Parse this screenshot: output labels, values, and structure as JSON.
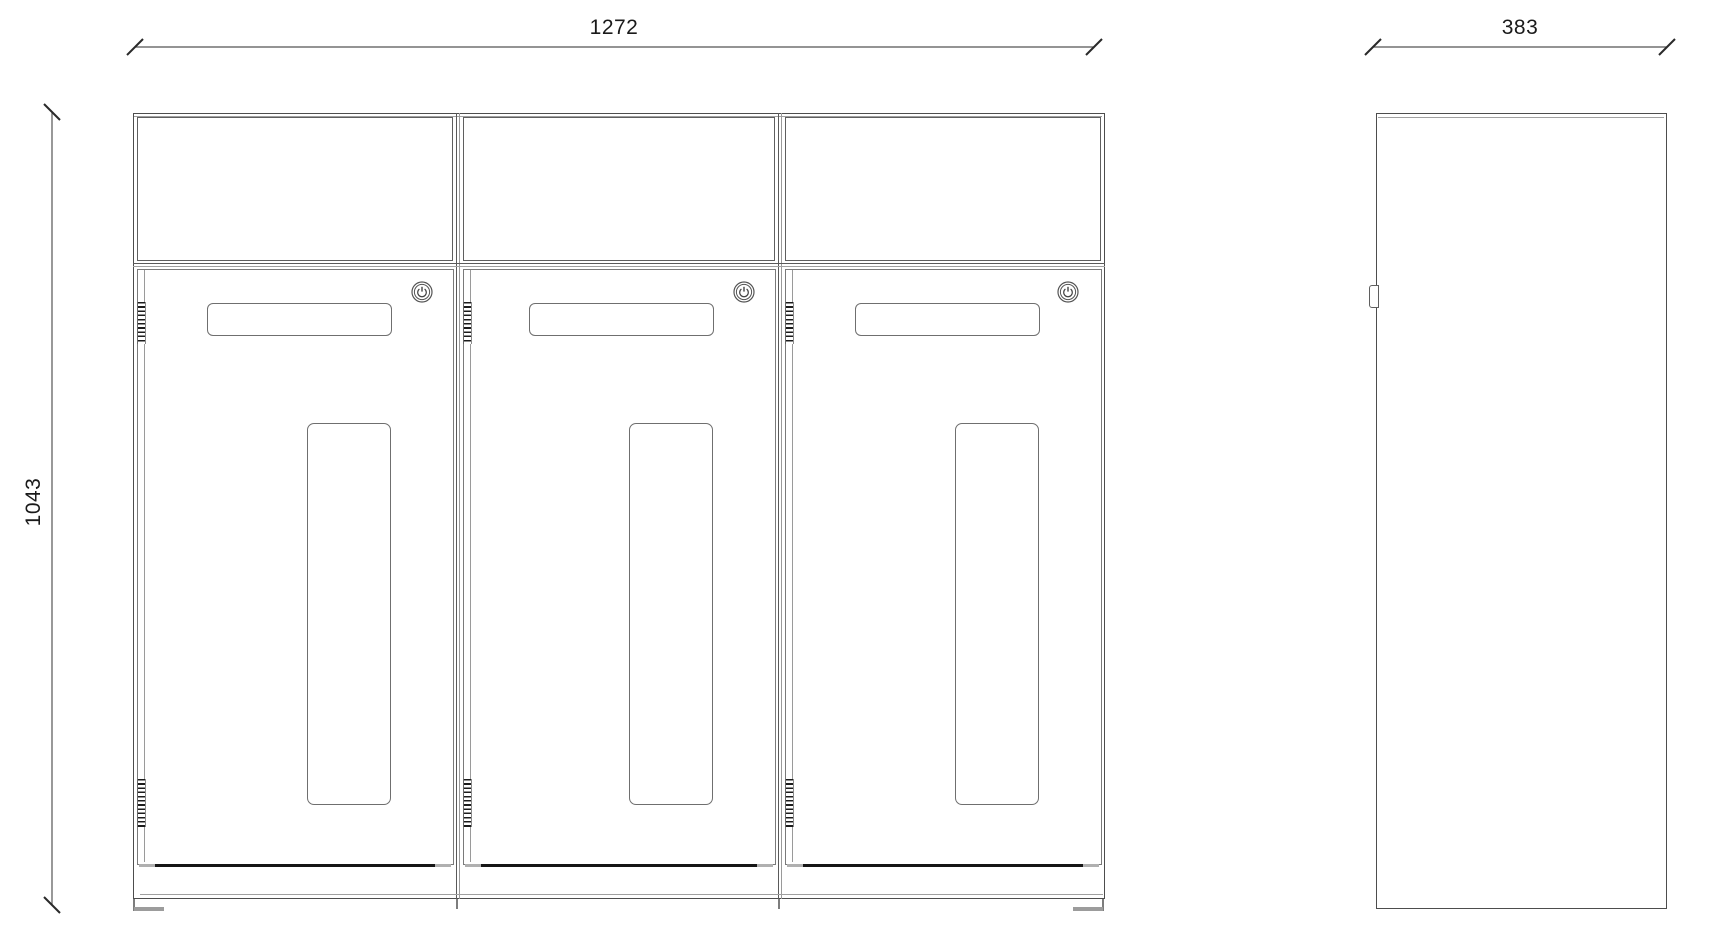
{
  "drawing": {
    "front_view": {
      "name": "front-elevation",
      "width_label": "1272",
      "height_label": "1043",
      "compartments": 3
    },
    "side_view": {
      "name": "side-elevation",
      "depth_label": "383"
    },
    "icons": {
      "lock": "cam-lock-icon",
      "hinge": "hinge-rib-band",
      "dimension_tick": "cad-slash-tick"
    },
    "colors": {
      "background": "#ffffff",
      "line_dark": "#4d4d4d",
      "line_mid": "#6f6f6f",
      "line_light": "#a0a0a0",
      "door_gap": "#161616",
      "foot": "#9c9c9c",
      "text": "#1a1a1a"
    }
  }
}
